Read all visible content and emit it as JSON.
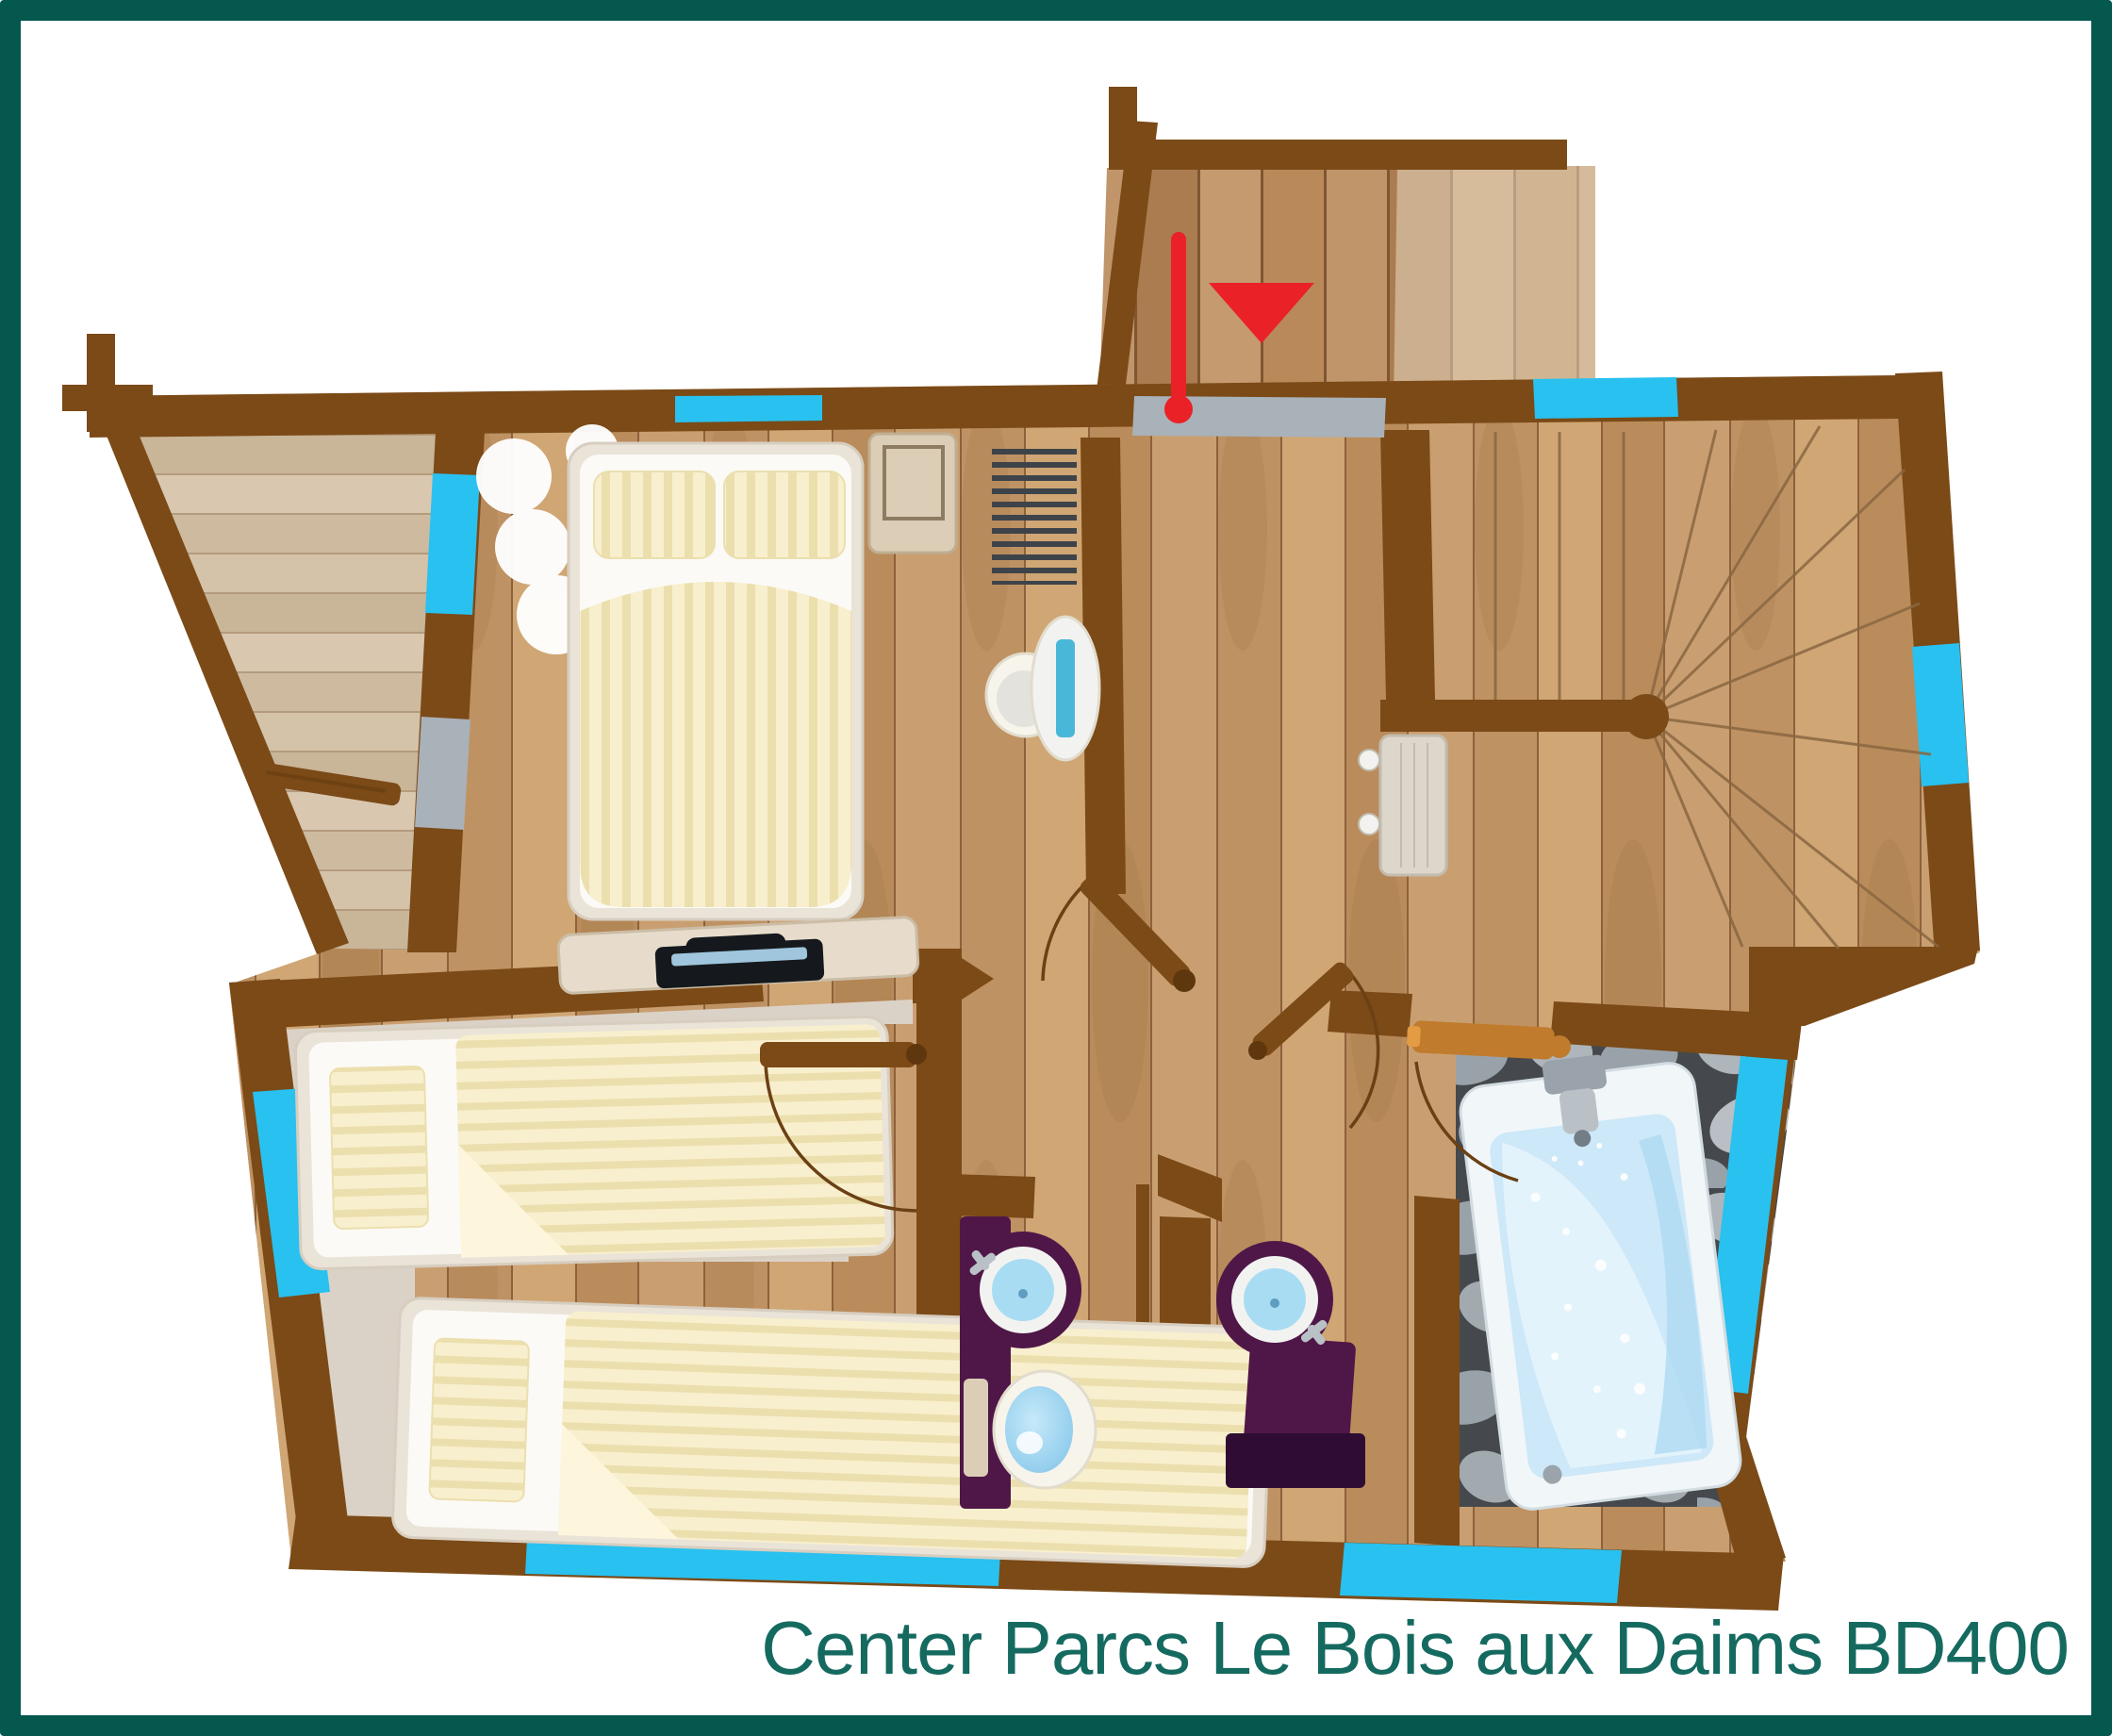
{
  "caption": "Center Parcs Le Bois aux Daims BD400",
  "icons": {
    "entrance_arrow": "red-triangle-down marking the entrance door",
    "door_swing": "quarter-arc door swing indicator",
    "window": "cyan wall segment",
    "stairs": "winder staircase with radiating treads"
  },
  "colors": {
    "frame": "#04584e",
    "caption": "#156a60",
    "wall": "#7b4a17",
    "wall_deep": "#5f370e",
    "window": "#29c1ef",
    "threshold": "#a9b1b9",
    "red": "#ea2127",
    "orange_door": "#c07b2c",
    "orange_door_hi": "#e39b44",
    "wood_a": "#cfa674",
    "wood_b": "#ba8c5b",
    "wood_c": "#c99f71",
    "wood_d": "#bf9263",
    "wood_seam": "#8d613b",
    "terrace_a": "#d9c7b0",
    "terrace_b": "#cebb9f",
    "terrace_c": "#d4c2a9",
    "terrace_d": "#c9b598",
    "terrace_seam": "#b49b7d",
    "deck_a": "#b9895a",
    "deck_b": "#c1956a",
    "deck_c": "#aa7c4f",
    "deck_d": "#c59a6e",
    "deck_seam": "#7f5631",
    "deck_light": "#e6d8c2",
    "carpet": "#dbd2c7",
    "stone_gap": "#45494d",
    "stone_a": "#aeb5bb",
    "stone_b": "#9aa2a9",
    "stone_c": "#b9bfc4",
    "stone_d": "#a2aab0",
    "bed_frame": "#eae3d8",
    "bed_frame_edge": "#d7cec0",
    "mattress": "#fbfaf6",
    "cream": "#f8efce",
    "cream_stripe": "#ecdfae",
    "duvet_fold": "#fdf6dd",
    "purple": "#4f1747",
    "purple_deep": "#2f0d33",
    "sink_rim": "#f2f3f1",
    "sink_blue": "#a8dcf2",
    "toilet": "#f7f4ec",
    "toilet_edge": "#e2dccd",
    "water_hi": "#c6e9f9",
    "water_lo": "#86c7ea",
    "tub_rim": "#f1f6f9",
    "tub_rim_edge": "#d2dce1",
    "tub_basin": "#cde8f8",
    "tub_leaf": "#e6f4fc",
    "tub_deep": "#aed9f2",
    "chrome": "#9aa3ab",
    "chrome_dark": "#727d85",
    "chrome_light": "#b9c1c7",
    "slat": "#3e434a",
    "stair_line": "#8a6742",
    "arc": "#6b4014",
    "bench": "#ddd6cb",
    "bench_edge": "#c2bbae",
    "knob": "#f4f2ee",
    "towel": "#49b8d8",
    "nightstand": "#dccdb7",
    "nightstand_edge": "#bfae92",
    "frame_line": "#8d7c62",
    "dresser": "#e7dccb",
    "dresser_edge": "#cbbda6",
    "laptop": "#15191d",
    "laptop_screen": "#9fc6dd"
  }
}
